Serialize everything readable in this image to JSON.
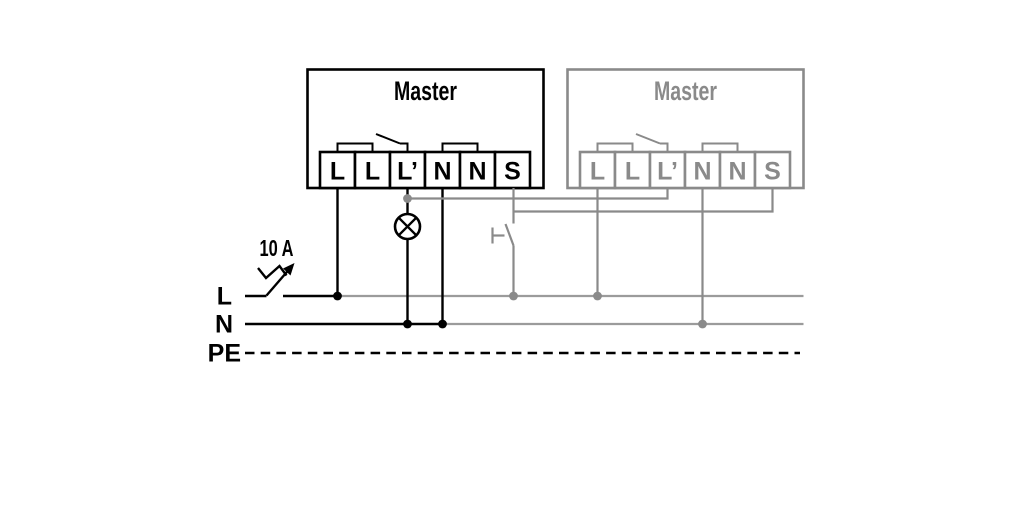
{
  "diagram": {
    "left_master": {
      "title": "Master",
      "terminals": [
        "L",
        "L",
        "L’",
        "N",
        "N",
        "S"
      ]
    },
    "right_master": {
      "title": "Master",
      "terminals": [
        "L",
        "L",
        "L’",
        "N",
        "N",
        "S"
      ]
    },
    "breaker": {
      "label": "10 A"
    },
    "bus": {
      "line_label": "L",
      "neutral_label": "N",
      "earth_label": "PE"
    },
    "colors": {
      "active_wire": "#000000",
      "inactive_wire": "#8a8a8a",
      "inactive_bus": "#9b9b9b"
    }
  }
}
